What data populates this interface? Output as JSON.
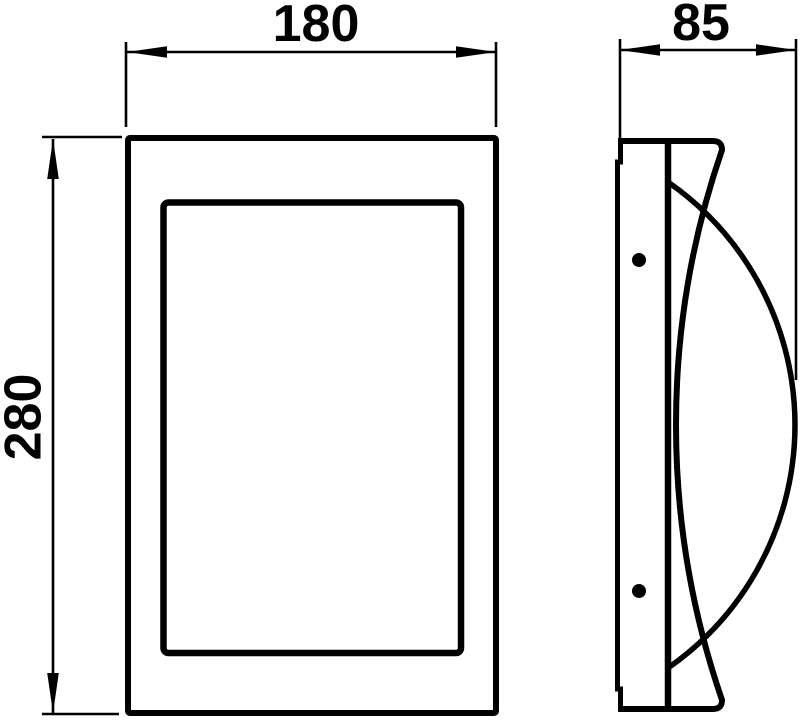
{
  "colors": {
    "background": "#ffffff",
    "lines": "#000000",
    "text": "#000000"
  },
  "drawing": {
    "kind": "technical-dimension-drawing",
    "dimensions": {
      "width": {
        "label": "180",
        "value": 180
      },
      "height": {
        "label": "280",
        "value": 280
      },
      "depth": {
        "label": "85",
        "value": 85
      }
    }
  }
}
